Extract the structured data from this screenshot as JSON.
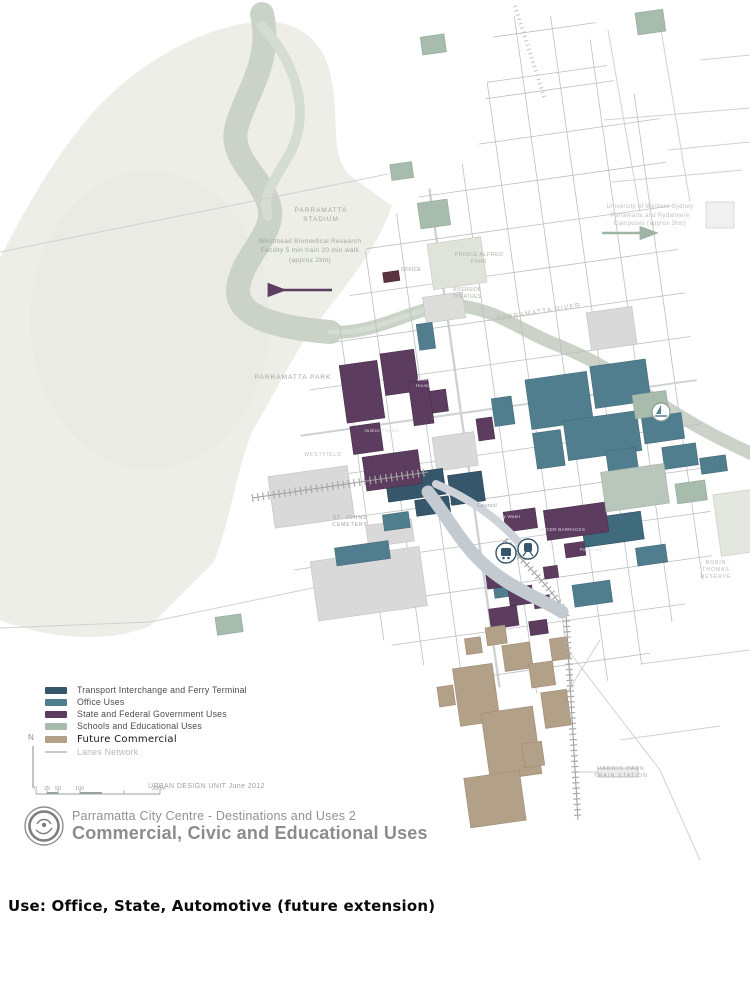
{
  "title": {
    "line1": "Parramatta City Centre - Destinations and Uses 2",
    "line2": "Commercial, Civic and Educational Uses"
  },
  "caption": "Use: Office, State, Automotive (future extension)",
  "legend": {
    "items": [
      {
        "label": "Transport Interchange and Ferry Terminal",
        "color": "#35566B"
      },
      {
        "label": "Office Uses",
        "color": "#517E8E"
      },
      {
        "label": "State and Federal Government Uses",
        "color": "#5D3D5F"
      },
      {
        "label": "Schools and Educational Uses",
        "color": "#A7BCAD"
      },
      {
        "label": "Future Commercial",
        "color": "#B3A089"
      },
      {
        "label": "Lanes Network",
        "color": "#CCCCCC"
      }
    ]
  },
  "scalebar": {
    "north_label": "N",
    "ticks": [
      "0",
      "25",
      "50",
      "100",
      "200m"
    ],
    "credit": "URBAN DESIGN UNIT June 2012"
  },
  "map": {
    "labels": {
      "stadium": "PARRAMATTA STADIUM",
      "park": "PARRAMATTA PARK",
      "river": "PARRAMATTA RIVER",
      "westmead_note": "Westmead Biomedical Research Facility 5 min train 20 min walk (approx 2km)",
      "uws_note": "University of Western Sydney Parramatta and Rydalmere Campuses (approx 2km)",
      "prince_alfred_park": "PRINCE ALFRED PARK",
      "riverside_theatres": "RIVERSIDE THEATRES",
      "office": "OFFICE",
      "council": "Council",
      "sydney_water": "Sydney Water",
      "lancer_barracks": "LANCER BARRACKS",
      "police_hq": "Police HQ",
      "court_house": "Court House",
      "justice_precinct": "Justice Precinct",
      "st_johns_cemetery": "ST. JOHNS CEMETERY",
      "westfield": "WESTFIELD",
      "robin_thomas_reserve": "ROBIN THOMAS RESERVE",
      "harris_park_station": "HARRIS PARK TRAIN STATION"
    },
    "colors": {
      "park": "#edeee8",
      "river": "#cbd3c9",
      "civic_gray": "#d9d9d9",
      "road_band": "#c3cad0"
    }
  }
}
